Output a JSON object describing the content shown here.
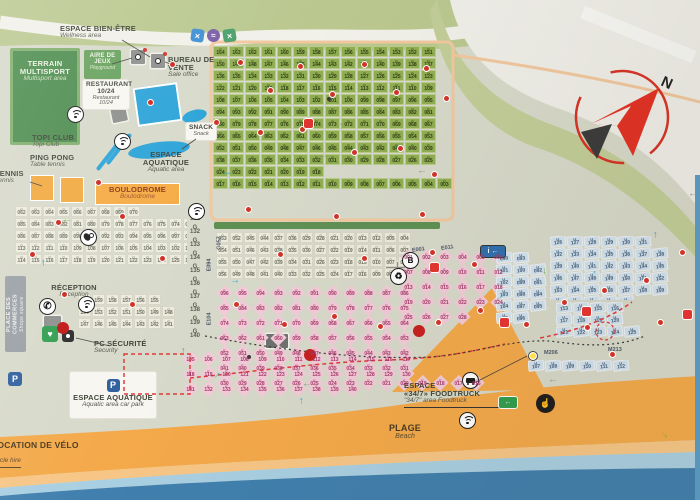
{
  "labels": {
    "wellness": {
      "fr": "ESPACE BIEN-ÊTRE",
      "en": "Wellness area"
    },
    "multisport": {
      "fr": "TERRAIN MULTISPORT",
      "en": "Multisport area"
    },
    "playground": {
      "fr": "AIRE DE JEUX",
      "en": "Playground"
    },
    "restaurant": {
      "fr": "RESTAURANT",
      "hours": "10/24",
      "en": "Restaurant",
      "hours_en": "10/24"
    },
    "sales_office": {
      "fr": "BUREAU DE VENTE",
      "en": "Sale office"
    },
    "topi_club": {
      "fr": "TOPI CLUB",
      "en": "Topi Club"
    },
    "ping_pong": {
      "fr": "PING PONG",
      "en": "Table tennis"
    },
    "tennis": {
      "fr": "TENNIS",
      "en": "Tennis"
    },
    "snack": {
      "fr": "SNACK",
      "en": "Snack"
    },
    "aquatic": {
      "fr": "ESPACE AQUATIQUE",
      "en": "Aquatic area"
    },
    "boulodrome": {
      "fr": "BOULODROME",
      "en": "Boulodrome"
    },
    "reception": {
      "fr": "RÉCEPTION",
      "en": "Reception"
    },
    "security": {
      "fr": "PC SÉCURITÉ",
      "en": "Security"
    },
    "aquatic_carpark": {
      "fr": "ESPACE AQUATIQUE",
      "en": "Aquatic area car park"
    },
    "bike_hire": {
      "fr": "LOCATION DE VÉLO",
      "en": "Cycle hire"
    },
    "beach": {
      "fr": "PLAGE",
      "en": "Beach"
    },
    "foodtruck": {
      "fr1": "ESPACE",
      "fr2": "«34/7» FOODTRUCK",
      "en": "\"34/7\" area Foodtruck"
    },
    "shops": {
      "fr": "PLACE DES COMMERCES",
      "en": "Shops square"
    }
  },
  "compass": {
    "north": "N"
  },
  "icon_glyphs": {
    "parking": "P",
    "phone": "✆",
    "aed": "♥",
    "bus": "B",
    "info": "i ←",
    "recycle": "♻",
    "exit": "←",
    "hand": "☝",
    "cross": "×",
    "wave": "≈"
  },
  "area_labels": [
    {
      "text": "M206",
      "x": 544,
      "y": 350,
      "rot": 0
    },
    {
      "text": "M213",
      "x": 608,
      "y": 347,
      "rot": 0
    },
    {
      "text": "E001",
      "x": 412,
      "y": 247,
      "rot": -8
    },
    {
      "text": "E011",
      "x": 441,
      "y": 245,
      "rot": -8
    },
    {
      "text": "E094",
      "x": 203,
      "y": 262,
      "rot": -90
    },
    {
      "text": "E104",
      "x": 203,
      "y": 316,
      "rot": -90
    },
    {
      "text": "G057",
      "x": 213,
      "y": 240,
      "rot": -90
    }
  ],
  "zones": {
    "p": {
      "prefix": "P",
      "rows": [
        {
          "from": 164,
          "to": 151
        },
        {
          "from": 150,
          "to": 137
        },
        {
          "from": 136,
          "to": 123
        },
        {
          "from": 122,
          "to": 109
        },
        {
          "from": 108,
          "to": 95
        },
        {
          "from": 94,
          "to": 81
        },
        {
          "from": 80,
          "to": 67
        },
        {
          "from": 66,
          "to": 53
        },
        {
          "from": 52,
          "to": 39
        },
        {
          "from": 38,
          "to": 25
        },
        {
          "from": 24,
          "to": 18
        },
        {
          "from": 17,
          "to": 1
        }
      ]
    },
    "g_left": {
      "prefix": "G",
      "rows": [
        {
          "from": 62,
          "to": 70
        },
        {
          "from": 85,
          "to": 71
        },
        {
          "from": 86,
          "to": 100
        },
        {
          "from": 113,
          "to": 101
        },
        {
          "from": 114,
          "to": 130
        }
      ]
    },
    "g_reception": {
      "prefix": "G",
      "rows": [
        {
          "from": 160,
          "to": 155
        },
        {
          "from": 154,
          "to": 148
        },
        {
          "from": 147,
          "to": 141
        }
      ]
    },
    "g_col": {
      "prefix": "G",
      "rows": [
        {
          "from": 131,
          "to": 131
        },
        {
          "from": 132,
          "to": 132
        },
        {
          "from": 133,
          "to": 133
        },
        {
          "from": 134,
          "to": 134
        },
        {
          "from": 135,
          "to": 135
        },
        {
          "from": 136,
          "to": 136
        },
        {
          "from": 137,
          "to": 137
        },
        {
          "from": 138,
          "to": 138
        },
        {
          "from": 139,
          "to": 139
        },
        {
          "from": 140,
          "to": 140
        }
      ]
    },
    "g_center": {
      "prefix": "G",
      "rows": [
        [
          "053",
          "052",
          "045",
          "044",
          "037",
          "036",
          "029",
          "028",
          "021",
          "020",
          "013",
          "012",
          "005",
          "004"
        ],
        [
          "054",
          "051",
          "046",
          "043",
          "038",
          "035",
          "030",
          "027",
          "022",
          "019",
          "014",
          "011",
          "006",
          "003"
        ],
        [
          "055",
          "050",
          "047",
          "042",
          "039",
          "034",
          "031",
          "026",
          "023",
          "018",
          "015",
          "010",
          "007",
          "002"
        ],
        [
          "056",
          "049",
          "048",
          "041",
          "040",
          "033",
          "032",
          "025",
          "024",
          "017",
          "016",
          "009",
          "008",
          "001"
        ]
      ]
    },
    "e_main": {
      "prefix": "E",
      "rows": [
        {
          "from": 96,
          "to": 86
        },
        {
          "from": 85,
          "to": 75
        },
        {
          "from": 74,
          "to": 64
        },
        {
          "from": 63,
          "to": 53
        },
        {
          "from": 52,
          "to": 42
        },
        {
          "from": 41,
          "to": 31
        },
        {
          "from": 30,
          "to": 16
        }
      ]
    },
    "e_beach": {
      "prefix": "E",
      "rows": [
        {
          "from": 105,
          "to": 117
        },
        {
          "from": 118,
          "to": 130
        },
        {
          "from": 131,
          "to": 140
        }
      ]
    },
    "e_right": {
      "prefix": "E",
      "rows": [
        {
          "from": 1,
          "to": 6
        },
        {
          "from": 7,
          "to": 12
        },
        {
          "from": 13,
          "to": 18
        },
        {
          "from": 19,
          "to": 24
        },
        {
          "from": 25,
          "to": 28
        }
      ]
    },
    "m_a": {
      "prefix": "M",
      "rows": [
        [
          "090",
          "093"
        ],
        [
          "101",
          "100",
          "092"
        ],
        [
          "102",
          "099",
          "091"
        ],
        [
          "103",
          "098",
          "094"
        ],
        [
          "104",
          "097",
          "095"
        ],
        [
          "105",
          "096"
        ]
      ]
    },
    "m_b": {
      "prefix": "M",
      "rows": [
        {
          "from": 126,
          "to": 131
        },
        {
          "from": 132,
          "to": 138
        },
        {
          "from": 139,
          "to": 145
        },
        {
          "from": 146,
          "to": 152
        },
        {
          "from": 153,
          "to": 159
        },
        {
          "from": 160,
          "to": 164
        }
      ]
    },
    "m_low": {
      "prefix": "M",
      "rows": [
        {
          "from": 113,
          "to": 116
        },
        {
          "from": 117,
          "to": 120
        },
        {
          "from": 121,
          "to": 125
        }
      ]
    },
    "m_bottom": {
      "prefix": "M",
      "rows": [
        {
          "from": 107,
          "to": 112
        }
      ]
    }
  },
  "markers": [
    {
      "t": "rd",
      "x": 238,
      "y": 60
    },
    {
      "t": "rd",
      "x": 268,
      "y": 88
    },
    {
      "t": "rd",
      "x": 298,
      "y": 64
    },
    {
      "t": "rd",
      "x": 330,
      "y": 92
    },
    {
      "t": "rd",
      "x": 362,
      "y": 62
    },
    {
      "t": "rd",
      "x": 394,
      "y": 90
    },
    {
      "t": "rd",
      "x": 424,
      "y": 66
    },
    {
      "t": "rd",
      "x": 444,
      "y": 96
    },
    {
      "t": "rd",
      "x": 258,
      "y": 130
    },
    {
      "t": "rd",
      "x": 300,
      "y": 127
    },
    {
      "t": "rd",
      "x": 352,
      "y": 150
    },
    {
      "t": "rd",
      "x": 398,
      "y": 146
    },
    {
      "t": "rd",
      "x": 432,
      "y": 172
    },
    {
      "t": "rd",
      "x": 246,
      "y": 207
    },
    {
      "t": "rd",
      "x": 334,
      "y": 214
    },
    {
      "t": "rd",
      "x": 420,
      "y": 212
    },
    {
      "t": "rd",
      "x": 278,
      "y": 252
    },
    {
      "t": "rd",
      "x": 362,
      "y": 256
    },
    {
      "t": "rd",
      "x": 430,
      "y": 250
    },
    {
      "t": "rd",
      "x": 472,
      "y": 262
    },
    {
      "t": "rd",
      "x": 234,
      "y": 302
    },
    {
      "t": "rd",
      "x": 282,
      "y": 322
    },
    {
      "t": "rd",
      "x": 332,
      "y": 314
    },
    {
      "t": "rd",
      "x": 378,
      "y": 324
    },
    {
      "t": "rd",
      "x": 436,
      "y": 320
    },
    {
      "t": "rd",
      "x": 478,
      "y": 308
    },
    {
      "t": "rd",
      "x": 524,
      "y": 322
    },
    {
      "t": "rd",
      "x": 562,
      "y": 300
    },
    {
      "t": "rd",
      "x": 602,
      "y": 288
    },
    {
      "t": "rd",
      "x": 644,
      "y": 278
    },
    {
      "t": "rd",
      "x": 610,
      "y": 352
    },
    {
      "t": "rd",
      "x": 658,
      "y": 320
    },
    {
      "t": "rd",
      "x": 120,
      "y": 214
    },
    {
      "t": "rd",
      "x": 56,
      "y": 220
    },
    {
      "t": "rd",
      "x": 30,
      "y": 252
    },
    {
      "t": "rd",
      "x": 62,
      "y": 292
    },
    {
      "t": "rd",
      "x": 160,
      "y": 256
    },
    {
      "t": "rd",
      "x": 130,
      "y": 302
    },
    {
      "t": "rd",
      "x": 96,
      "y": 180
    },
    {
      "t": "rd",
      "x": 148,
      "y": 100
    },
    {
      "t": "rd",
      "x": 170,
      "y": 62
    },
    {
      "t": "rd",
      "x": 214,
      "y": 120
    },
    {
      "t": "rd",
      "x": 680,
      "y": 250
    },
    {
      "t": "rd",
      "x": 585,
      "y": 325
    },
    {
      "t": "bd",
      "x": 247,
      "y": 355
    },
    {
      "t": "bd",
      "x": 327,
      "y": 97
    },
    {
      "t": "RD",
      "x": 57,
      "y": 322
    },
    {
      "t": "RD",
      "x": 304,
      "y": 349
    },
    {
      "t": "RD",
      "x": 413,
      "y": 325
    },
    {
      "t": "rs",
      "x": 304,
      "y": 119
    },
    {
      "t": "rs",
      "x": 582,
      "y": 307
    },
    {
      "t": "rs",
      "x": 683,
      "y": 310
    },
    {
      "t": "rs",
      "x": 500,
      "y": 318
    },
    {
      "t": "rs",
      "x": 430,
      "y": 263
    },
    {
      "t": "yd",
      "x": 529,
      "y": 352
    },
    {
      "t": "ar",
      "x": 222,
      "y": 168,
      "c": "#2fa7d8",
      "r": 0
    },
    {
      "t": "ar",
      "x": 230,
      "y": 276,
      "c": "#2fa7d8",
      "r": 0
    },
    {
      "t": "ar",
      "x": 38,
      "y": 258,
      "c": "#2fa7d8",
      "r": -90
    },
    {
      "t": "ar",
      "x": 650,
      "y": 230,
      "c": "#2fa7d8",
      "r": -90
    },
    {
      "t": "ar",
      "x": 588,
      "y": 268,
      "c": "#2fa7d8",
      "r": -45
    },
    {
      "t": "ar",
      "x": 497,
      "y": 291,
      "c": "#2fa7d8",
      "r": -45
    },
    {
      "t": "ar",
      "x": 212,
      "y": 370,
      "c": "#2fa7d8",
      "r": -45
    },
    {
      "t": "ar",
      "x": 296,
      "y": 396,
      "c": "#2fa7d8",
      "r": -90
    },
    {
      "t": "ar",
      "x": 178,
      "y": 346,
      "c": "#6fae4b",
      "r": -90
    },
    {
      "t": "ar",
      "x": 62,
      "y": 216,
      "c": "#6fae4b",
      "r": 180
    },
    {
      "t": "ar",
      "x": 540,
      "y": 266,
      "c": "#6fae4b",
      "r": 90
    },
    {
      "t": "ar",
      "x": 660,
      "y": 430,
      "c": "#6fae4b",
      "r": 45
    },
    {
      "t": "ar",
      "x": 318,
      "y": 152,
      "c": "#90938a",
      "r": 180
    },
    {
      "t": "ar",
      "x": 417,
      "y": 167,
      "c": "#90938a",
      "r": 180
    },
    {
      "t": "ar",
      "x": 336,
      "y": 121,
      "c": "#90938a",
      "r": -90
    },
    {
      "t": "ar",
      "x": 548,
      "y": 376,
      "c": "#90938a",
      "r": 180
    },
    {
      "t": "ar",
      "x": 302,
      "y": 380,
      "c": "#90938a",
      "r": 180
    },
    {
      "t": "ar",
      "x": 688,
      "y": 190,
      "c": "#90938a",
      "r": 180
    }
  ],
  "colors": {
    "ground": "#d7d9ca",
    "olive": "#bac88f",
    "paper": "#efeee8",
    "multisport_green": "#4c8c4e",
    "playground_green": "#66a15c",
    "pool_blue": "#2ba3d8",
    "court_orange": "#f2a93f",
    "beach_orange": "#f4a94a",
    "beach_light": "#f7c686",
    "sea_light": "#a9cfe2",
    "sea_deep": "#407fae",
    "pitch_green": "#8fae51",
    "pitch_pink": "#f3cbd9",
    "pitch_beige": "#ecebdd",
    "pitch_blue": "#d3e2ee",
    "hedge": "#5e9054",
    "path_peach": "#f1c79e",
    "marker_red": "#cf3428",
    "compass_red": "#e23125"
  }
}
